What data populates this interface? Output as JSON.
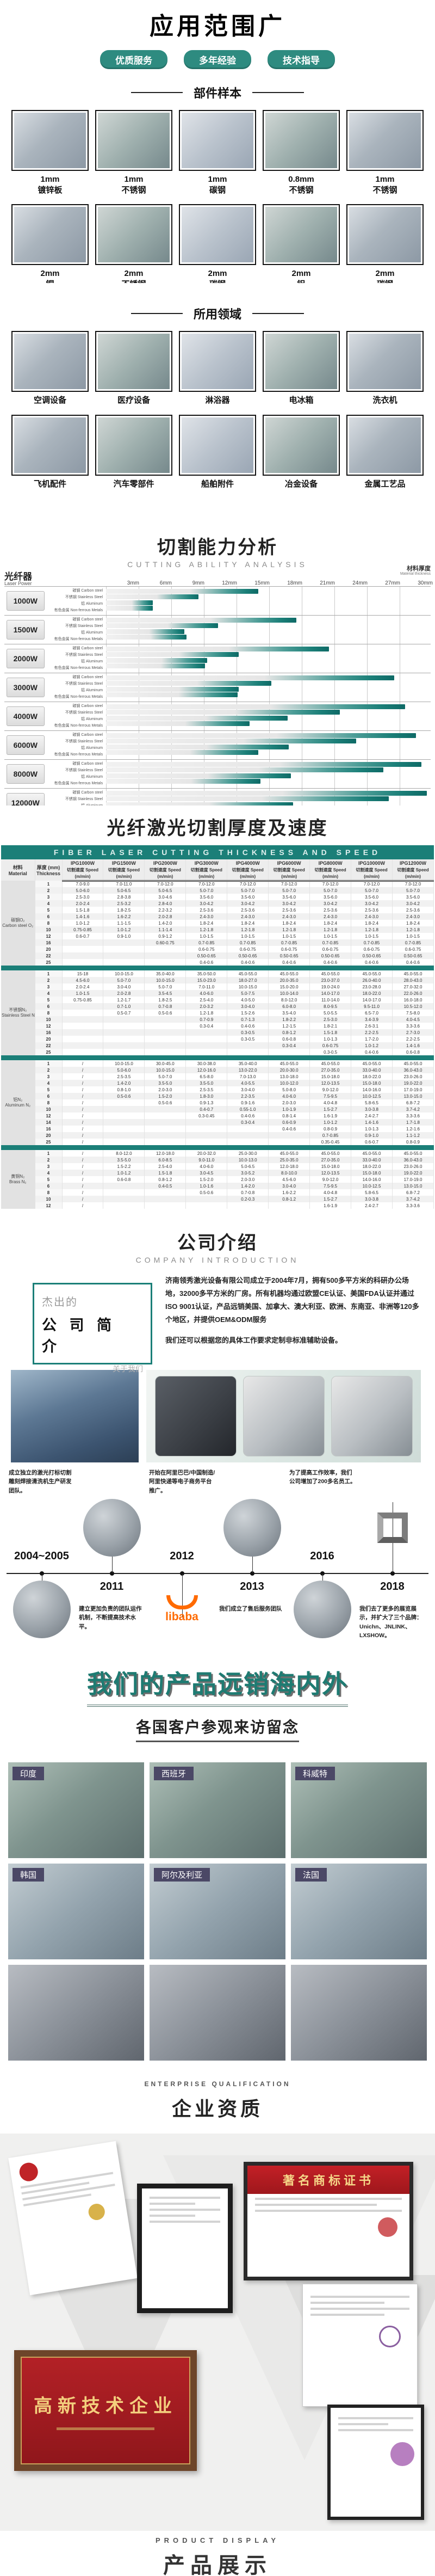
{
  "colors": {
    "accent": "#1b7f78",
    "pill": "#2e8b80",
    "teal_heading": "#1e7b72",
    "photo_tag": "#4b4866",
    "plaque_red": "#b01f24",
    "alibaba_orange": "#ff6a00"
  },
  "hero": {
    "title": "应用范围广",
    "badges": [
      "优质服务",
      "多年经验",
      "技术指导"
    ]
  },
  "samples": {
    "heading": "部件样本",
    "items": [
      {
        "size": "1mm",
        "material": "镀锌板"
      },
      {
        "size": "1mm",
        "material": "不锈钢"
      },
      {
        "size": "1mm",
        "material": "碳钢"
      },
      {
        "size": "0.8mm",
        "material": "不锈钢"
      },
      {
        "size": "1mm",
        "material": "不锈钢"
      },
      {
        "size": "2mm",
        "material": "铜"
      },
      {
        "size": "2mm",
        "material": "不锈钢"
      },
      {
        "size": "2mm",
        "material": "碳钢"
      },
      {
        "size": "2mm",
        "material": "铝"
      },
      {
        "size": "2mm",
        "material": "碳钢"
      }
    ]
  },
  "fields": {
    "heading": "所用领域",
    "items": [
      "空调设备",
      "医疗设备",
      "淋浴器",
      "电冰箱",
      "洗衣机",
      "飞机配件",
      "汽车零部件",
      "船舶附件",
      "冶金设备",
      "金属工艺品"
    ]
  },
  "cutting": {
    "title": "切割能力分析",
    "subtitle": "CUTTING ABILITY ANALYSIS",
    "axis_note_cn": "材料厚度",
    "axis_note_en": "Material thickness",
    "power_head_cn": "光纤器",
    "power_head_en": "Laser Power",
    "legend": "最大切割厚度（不建议长期使用）",
    "chart_data": {
      "type": "bar",
      "orientation": "horizontal",
      "unit": "mm",
      "xlim": [
        0,
        30
      ],
      "x_ticks": [
        "3mm",
        "6mm",
        "9mm",
        "12mm",
        "15mm",
        "18mm",
        "21mm",
        "24mm",
        "27mm",
        "30mm"
      ],
      "materials": [
        "碳钢 Carbon steel",
        "不锈钢 Stainless Steel",
        "铝 Aluminum",
        "有色金属 Non-ferrous Metals"
      ],
      "series": [
        {
          "power": "1000W",
          "values": [
            14,
            8.5,
            4.3,
            4.3
          ]
        },
        {
          "power": "1500W",
          "values": [
            17.5,
            10.3,
            7.2,
            7.4
          ]
        },
        {
          "power": "2000W",
          "values": [
            20.5,
            12.2,
            9.3,
            9.1
          ]
        },
        {
          "power": "3000W",
          "values": [
            26.5,
            15.2,
            12.2,
            12.1
          ]
        },
        {
          "power": "4000W",
          "values": [
            27.5,
            21.5,
            16.7,
            13.2
          ]
        },
        {
          "power": "6000W",
          "values": [
            28.5,
            23,
            16.8,
            14
          ]
        },
        {
          "power": "8000W",
          "values": [
            29,
            25.5,
            17,
            14.2
          ]
        },
        {
          "power": "12000W",
          "values": [
            29.5,
            26,
            17.2,
            14.5
          ]
        }
      ]
    }
  },
  "speed_table": {
    "title": "光纤激光切割厚度及速度",
    "banner": "FIBER LASER CUTTING THICKNESS AND SPEED",
    "col_material_cn": "材料",
    "col_material_en": "Material",
    "col_thickness_cn": "厚度 (mm)",
    "col_thickness_en": "Thickness",
    "speed_label": "切割速度 Speed",
    "unit_label": "(m/min)",
    "powers": [
      "IPG1000W",
      "IPG1500W",
      "IPG2000W",
      "IPG3000W",
      "IPG4000W",
      "IPG6000W",
      "IPG8000W",
      "IPG10000W",
      "IPG12000W"
    ],
    "groups": [
      {
        "cn": "碳钢O₂",
        "en": "Carbon steel O₂",
        "rows": [
          [
            "1",
            "7.0-9.0",
            "7.0-11.0",
            "7.0-12.0",
            "7.0-12.0",
            "7.0-12.0",
            "7.0-12.0",
            "7.0-12.0",
            "7.0-12.0",
            "7.0-12.0"
          ],
          [
            "2",
            "5.0-6.0",
            "5.0-6.5",
            "5.0-6.5",
            "5.0-7.0",
            "5.0-7.0",
            "5.0-7.0",
            "5.0-7.0",
            "5.0-7.0",
            "5.0-7.0"
          ],
          [
            "3",
            "2.5-3.0",
            "2.8-3.8",
            "3.0-4.6",
            "3.5-6.0",
            "3.5-6.0",
            "3.5-6.0",
            "3.5-6.0",
            "3.5-6.0",
            "3.5-6.0"
          ],
          [
            "4",
            "2.0-2.4",
            "2.5-3.2",
            "2.8-4.0",
            "3.0-4.2",
            "3.0-4.2",
            "3.0-4.2",
            "3.0-4.2",
            "3.0-4.2",
            "3.0-4.2"
          ],
          [
            "5",
            "1.5-1.8",
            "1.8-2.5",
            "2.2-3.2",
            "2.5-3.6",
            "2.5-3.6",
            "2.5-3.6",
            "2.5-3.6",
            "2.5-3.6",
            "2.5-3.6"
          ],
          [
            "6",
            "1.4-1.6",
            "1.6-2.2",
            "2.0-2.8",
            "2.4-3.0",
            "2.4-3.0",
            "2.4-3.0",
            "2.4-3.0",
            "2.4-3.0",
            "2.4-3.0"
          ],
          [
            "8",
            "1.0-1.2",
            "1.1-1.5",
            "1.4-2.0",
            "1.8-2.4",
            "1.8-2.4",
            "1.8-2.4",
            "1.8-2.4",
            "1.8-2.4",
            "1.8-2.4"
          ],
          [
            "10",
            "0.75-0.85",
            "1.0-1.2",
            "1.1-1.4",
            "1.2-1.8",
            "1.2-1.8",
            "1.2-1.8",
            "1.2-1.8",
            "1.2-1.8",
            "1.2-1.8"
          ],
          [
            "12",
            "0.6-0.7",
            "0.9-1.0",
            "0.9-1.2",
            "1.0-1.5",
            "1.0-1.5",
            "1.0-1.5",
            "1.0-1.5",
            "1.0-1.5",
            "1.0-1.5"
          ],
          [
            "16",
            "",
            "",
            "0.60-0.75",
            "0.7-0.85",
            "0.7-0.85",
            "0.7-0.85",
            "0.7-0.85",
            "0.7-0.85",
            "0.7-0.85"
          ],
          [
            "20",
            "",
            "",
            "",
            "0.6-0.75",
            "0.6-0.75",
            "0.6-0.75",
            "0.6-0.75",
            "0.6-0.75",
            "0.6-0.75"
          ],
          [
            "22",
            "",
            "",
            "",
            "0.50-0.65",
            "0.50-0.65",
            "0.50-0.65",
            "0.50-0.65",
            "0.50-0.65",
            "0.50-0.65"
          ],
          [
            "25",
            "",
            "",
            "",
            "0.4-0.6",
            "0.4-0.6",
            "0.4-0.6",
            "0.4-0.6",
            "0.4-0.6",
            "0.4-0.6"
          ]
        ]
      },
      {
        "cn": "不锈钢N₂",
        "en": "Stainless Steel N₂",
        "rows": [
          [
            "1",
            "15-18",
            "10.0-15.0",
            "35.0-40.0",
            "35.0-50.0",
            "45.0-55.0",
            "45.0-55.0",
            "45.0-55.0",
            "45.0-55.0",
            "45.0-55.0"
          ],
          [
            "2",
            "4.5-6.0",
            "5.0-7.0",
            "10.0-15.0",
            "15.0-23.0",
            "18.0-27.0",
            "20.0-35.0",
            "23.0-37.0",
            "26.0-40.0",
            "28.0-43.0"
          ],
          [
            "3",
            "2.0-2.4",
            "3.0-4.0",
            "5.0-7.0",
            "7.0-11.0",
            "10.0-15.0",
            "15.0-20.0",
            "19.0-24.0",
            "23.0-28.0",
            "27.0-32.0"
          ],
          [
            "4",
            "1.0-1.5",
            "2.0-2.8",
            "3.5-4.5",
            "4.0-6.0",
            "5.0-7.5",
            "10.0-14.0",
            "14.0-17.0",
            "18.0-22.0",
            "22.0-26.0"
          ],
          [
            "5",
            "0.75-0.85",
            "1.2-1.7",
            "1.8-2.5",
            "2.5-4.0",
            "4.0-5.0",
            "8.0-12.0",
            "11.0-14.0",
            "14.0-17.0",
            "16.0-18.0"
          ],
          [
            "6",
            "",
            "0.7-1.0",
            "0.7-0.8",
            "2.0-3.2",
            "3.0-4.0",
            "6.0-8.0",
            "8.0-9.5",
            "9.5-11.0",
            "10.5-12.0"
          ],
          [
            "8",
            "",
            "0.5-0.7",
            "0.5-0.6",
            "1.2-1.8",
            "1.5-2.6",
            "3.5-4.0",
            "5.0-5.5",
            "6.5-7.0",
            "7.5-8.0"
          ],
          [
            "10",
            "",
            "",
            "",
            "0.7-0.9",
            "0.7-1.3",
            "1.8-2.2",
            "2.5-3.0",
            "3.4-3.9",
            "4.0-4.5"
          ],
          [
            "12",
            "",
            "",
            "",
            "0.3-0.4",
            "0.4-0.6",
            "1.2-1.5",
            "1.8-2.1",
            "2.6-3.1",
            "3.3-3.6"
          ],
          [
            "16",
            "",
            "",
            "",
            "",
            "0.3-0.5",
            "0.8-1.2",
            "1.5-1.8",
            "2.2-2.5",
            "2.7-3.0"
          ],
          [
            "20",
            "",
            "",
            "",
            "",
            "0.3-0.5",
            "0.6-0.8",
            "1.0-1.3",
            "1.7-2.0",
            "2.2-2.5"
          ],
          [
            "22",
            "",
            "",
            "",
            "",
            "",
            "0.3-0.4",
            "0.6-0.75",
            "1.0-1.2",
            "1.4-1.6"
          ],
          [
            "25",
            "",
            "",
            "",
            "",
            "",
            "",
            "0.3-0.5",
            "0.4-0.6",
            "0.6-0.8"
          ]
        ]
      },
      {
        "cn": "铝N₂",
        "en": "Aluminum N₂",
        "rows": [
          [
            "1",
            "/",
            "10.0-15.0",
            "30.0-45.0",
            "30.0-38.0",
            "35.0-40.0",
            "45.0-55.0",
            "45.0-55.0",
            "45.0-55.0",
            "45.0-55.0"
          ],
          [
            "2",
            "/",
            "5.0-6.0",
            "10.0-15.0",
            "12.0-16.0",
            "13.0-22.0",
            "20.0-30.0",
            "27.0-35.0",
            "33.0-40.0",
            "36.0-43.0"
          ],
          [
            "3",
            "/",
            "2.5-3.5",
            "5.0-7.0",
            "6.5-8.0",
            "7.0-13.0",
            "13.0-18.0",
            "15.0-18.0",
            "18.0-22.0",
            "23.0-26.0"
          ],
          [
            "4",
            "/",
            "1.4-2.0",
            "3.5-5.0",
            "3.5-5.0",
            "4.0-5.5",
            "10.0-12.0",
            "12.0-13.5",
            "15.0-18.0",
            "19.0-22.0"
          ],
          [
            "5",
            "/",
            "0.8-1.0",
            "2.0-3.0",
            "2.5-3.5",
            "3.0-4.0",
            "5.0-8.0",
            "9.0-12.0",
            "14.0-16.0",
            "17.0-19.0"
          ],
          [
            "6",
            "/",
            "0.5-0.6",
            "1.5-2.0",
            "1.8-3.0",
            "2.2-3.5",
            "4.0-6.0",
            "7.5-9.5",
            "10.0-12.5",
            "13.0-15.0"
          ],
          [
            "8",
            "/",
            "",
            "0.5-0.6",
            "0.9-1.3",
            "0.9-1.6",
            "2.0-3.0",
            "4.0-4.8",
            "5.8-6.5",
            "6.8-7.2"
          ],
          [
            "10",
            "/",
            "",
            "",
            "0.4-0.7",
            "0.55-1.0",
            "1.0-1.9",
            "1.5-2.7",
            "3.0-3.8",
            "3.7-4.2"
          ],
          [
            "12",
            "/",
            "",
            "",
            "0.3-0.45",
            "0.4-0.6",
            "0.8-1.4",
            "1.6-1.9",
            "2.4-2.7",
            "3.3-3.6"
          ],
          [
            "14",
            "/",
            "",
            "",
            "",
            "0.3-0.4",
            "0.6-0.9",
            "1.0-1.2",
            "1.4-1.6",
            "1.7-1.8"
          ],
          [
            "16",
            "/",
            "",
            "",
            "",
            "",
            "0.4-0.6",
            "0.8-0.9",
            "1.0-1.3",
            "1.2-1.6"
          ],
          [
            "20",
            "/",
            "",
            "",
            "",
            "",
            "",
            "0.7-0.85",
            "0.9-1.0",
            "1.1-1.2"
          ],
          [
            "25",
            "/",
            "",
            "",
            "",
            "",
            "",
            "0.35-0.45",
            "0.6-0.7",
            "0.8-0.9"
          ]
        ]
      },
      {
        "cn": "黄铜N₂",
        "en": "Brass N₂",
        "rows": [
          [
            "1",
            "/",
            "8.0-12.0",
            "12.0-18.0",
            "20.0-32.0",
            "25.0-30.0",
            "45.0-55.0",
            "45.0-55.0",
            "45.0-55.0",
            "45.0-55.0"
          ],
          [
            "2",
            "/",
            "3.5-5.0",
            "6.0-8.5",
            "9.0-11.0",
            "10.0-13.0",
            "25.0-35.0",
            "27.0-35.0",
            "33.0-40.0",
            "36.0-43.0"
          ],
          [
            "3",
            "/",
            "1.5-2.2",
            "2.5-4.0",
            "4.0-6.0",
            "5.0-6.5",
            "12.0-18.0",
            "15.0-18.0",
            "18.0-22.0",
            "23.0-26.0"
          ],
          [
            "4",
            "/",
            "1.0-1.2",
            "1.5-1.8",
            "3.0-4.5",
            "3.0-5.2",
            "8.0-10.0",
            "12.0-13.5",
            "15.0-18.0",
            "19.0-22.0"
          ],
          [
            "5",
            "/",
            "0.6-0.8",
            "0.8-1.2",
            "1.5-2.0",
            "2.0-3.0",
            "4.5-6.0",
            "9.0-12.0",
            "14.0-16.0",
            "17.0-19.0"
          ],
          [
            "6",
            "/",
            "",
            "0.4-0.5",
            "1.0-1.6",
            "1.4-2.0",
            "3.0-4.0",
            "7.5-9.5",
            "10.0-12.5",
            "13.0-15.0"
          ],
          [
            "8",
            "/",
            "",
            "",
            "0.5-0.6",
            "0.7-0.8",
            "1.6-2.2",
            "4.0-4.8",
            "5.8-6.5",
            "6.8-7.2"
          ],
          [
            "10",
            "/",
            "",
            "",
            "",
            "0.2-0.3",
            "0.8-1.2",
            "1.5-2.7",
            "3.0-3.8",
            "3.7-4.2"
          ],
          [
            "12",
            "/",
            "",
            "",
            "",
            "",
            "",
            "1.6-1.9",
            "2.4-2.7",
            "3.3-3.6"
          ]
        ]
      }
    ]
  },
  "company": {
    "title": "公司介绍",
    "subtitle": "COMPANY INTRODUCTION",
    "box_line1": "杰出的",
    "box_line2": "公 司 简 介",
    "box_line3": "关于我们",
    "para1": "济南领秀激光设备有限公司成立于2004年7月，拥有500多平方米的科研办公场地，32000多平方米的厂房。所有机器均通过欧盟CE认证、美国FDA认证并通过ISO 9001认证，产品远销美国、加拿大、澳大利亚、欧洲、东南亚、非洲等120多个地区，并提供OEM&ODM服务",
    "para2": "我们还可以根据您的具体工作要求定制非标准辅助设备。"
  },
  "timeline": {
    "items": [
      {
        "year": "2004~2005",
        "text": "成立独立的激光打标切割雕刻焊接清洗机生产研发团队。",
        "text_side": "top",
        "media": "machine-photo"
      },
      {
        "year": "2011",
        "text": "建立更加负责的团队运作机制，不断提高技术水平。",
        "text_side": "bottom",
        "media": "collage-photo"
      },
      {
        "year": "2012",
        "text": "开始在阿里巴巴/中国制造/阿里快递等电子商务平台推广。",
        "text_side": "top",
        "media": "alibaba-logo"
      },
      {
        "year": "2013",
        "text": "我们成立了售后服务团队",
        "text_side": "bottom",
        "media": "showroom-photo"
      },
      {
        "year": "2016",
        "text": "为了提高工作效率，我们公司增加了200多名员工。",
        "text_side": "top",
        "media": "meeting-photo"
      },
      {
        "year": "2018",
        "text": "我们去了更多的展览展示，并扩大了三个品牌：Unichn、JNLINK、LXSHOW。",
        "text_side": "bottom",
        "media": "brand-logo"
      }
    ],
    "alibaba_word": "libaba"
  },
  "global_sales": {
    "title": "我们的产品远销海内外",
    "subtitle": "各国客户参观来访留念",
    "photo_labels": [
      [
        "印度",
        "西班牙",
        "科威特"
      ],
      [
        "韩国",
        "阿尔及利亚",
        "法国"
      ],
      [
        "",
        "",
        ""
      ]
    ]
  },
  "qualification": {
    "en": "ENTERPRISE QUALIFICATION",
    "cn": "企业资质",
    "plaque_text": "高新技术企业",
    "banner_cert_text": "著名商标证书"
  },
  "product_display": {
    "en": "PRODUCT DISPLAY",
    "cn": "产品展示"
  }
}
